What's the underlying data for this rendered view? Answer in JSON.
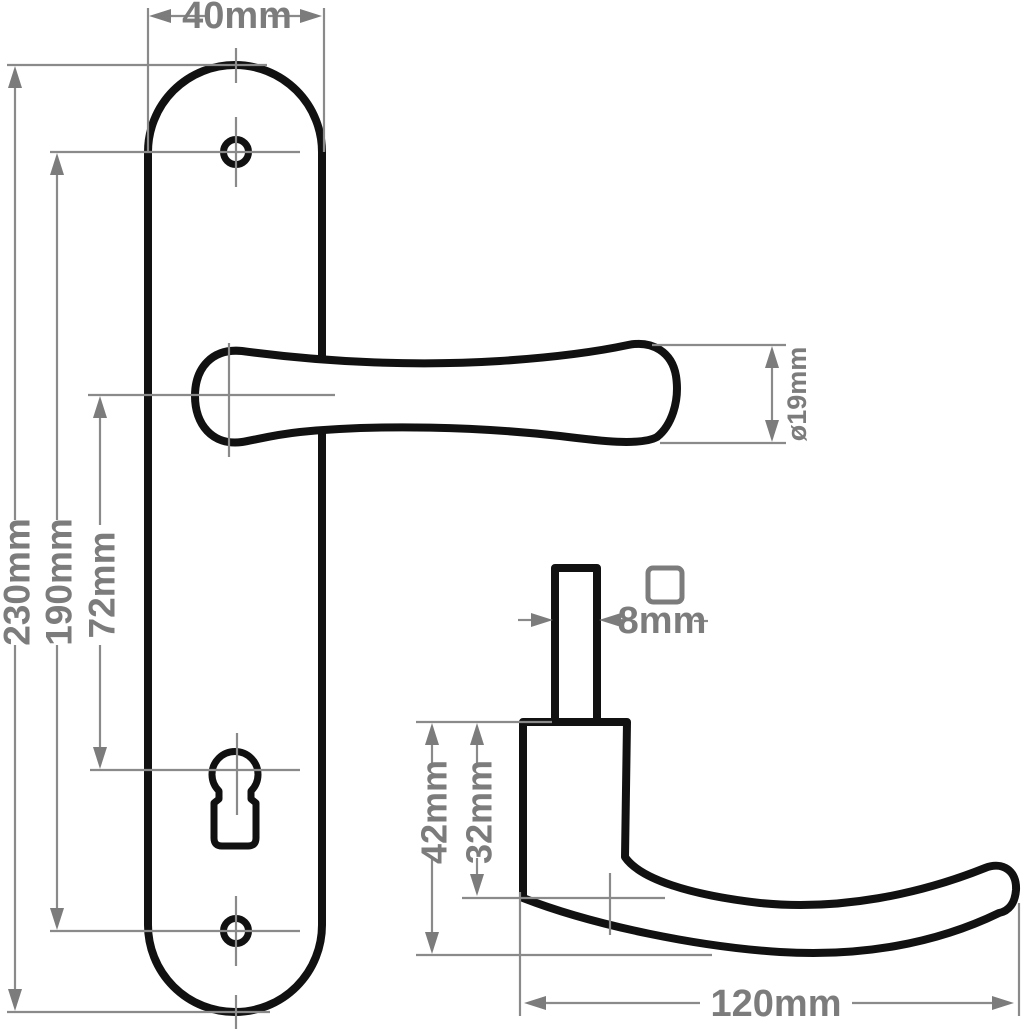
{
  "drawing": {
    "labels": {
      "plate_width": "40mm",
      "plate_height": "230mm",
      "screw_hole_centres": "190mm",
      "lever_to_keyhole": "72mm",
      "lever_diameter": "ø19mm",
      "spindle_size": "8mm",
      "rose_depth": "42mm",
      "neck_depth": "32mm",
      "lever_length": "120mm"
    },
    "icons": {
      "spindle_cross_section": "square-outline-icon"
    },
    "colors": {
      "outline": "#111111",
      "dimension_lines": "#8a8a8a",
      "dimension_text": "#7c7c7c",
      "background": "#ffffff"
    }
  }
}
